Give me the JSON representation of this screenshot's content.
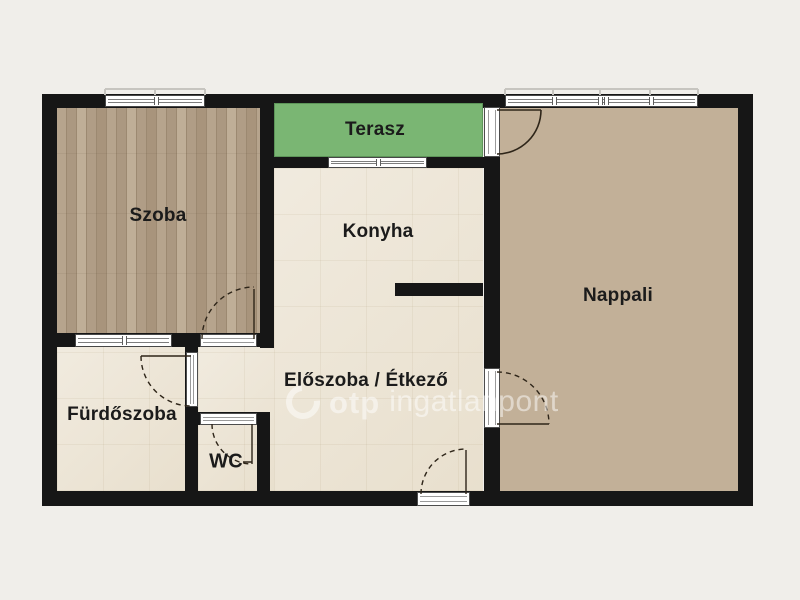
{
  "floorplan": {
    "rooms": {
      "szoba": {
        "label": "Szoba"
      },
      "terasz": {
        "label": "Terasz"
      },
      "konyha": {
        "label": "Konyha"
      },
      "nappali": {
        "label": "Nappali"
      },
      "eloszoba": {
        "label": "Előszoba / Étkező"
      },
      "furdoszoba": {
        "label": "Fürdőszoba"
      },
      "wc": {
        "label": "WC"
      }
    },
    "watermark": {
      "brand": "otp",
      "suffix": "ingatlanpont"
    },
    "colors": {
      "background": "#f0eeea",
      "wall": "#161616",
      "terrace_green": "#7ab673",
      "tile_floor": "#ece4d4",
      "wood_dark": "#b2a089",
      "wood_light": "#c2b098"
    }
  }
}
